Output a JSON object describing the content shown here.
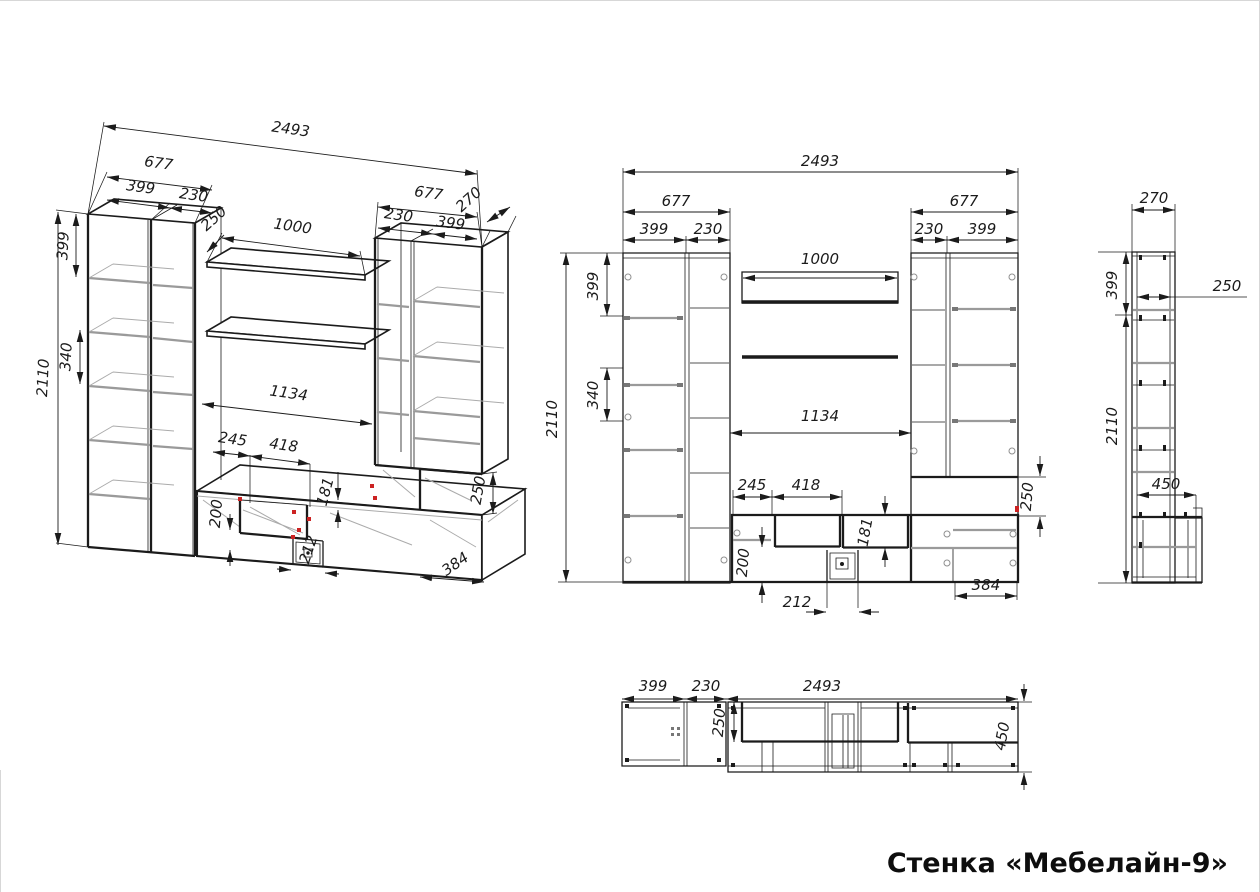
{
  "title": "Стенка «Мебелайн-9»",
  "colors": {
    "line": "#1b1b1b",
    "shelf_gray": "#9a9a9a",
    "accent_red": "#cc2222",
    "background": "#ffffff"
  },
  "dims": {
    "iso": {
      "total_width": "2493",
      "left_width": "677",
      "left_door": "399",
      "left_side": "230",
      "shelf_depth": "250",
      "shelf_width": "1000",
      "right_width": "677",
      "right_side": "230",
      "right_door": "399",
      "right_depth": "270",
      "top_height": "399",
      "mid_height": "340",
      "height": "2110",
      "niche_width": "1134",
      "w245": "245",
      "w418": "418",
      "h181": "181",
      "h200": "200",
      "w212": "212",
      "w384": "384",
      "h250": "250"
    },
    "front": {
      "total_width": "2493",
      "left_width": "677",
      "left_door": "399",
      "left_side": "230",
      "shelf_width": "1000",
      "right_width": "677",
      "right_side": "230",
      "right_door": "399",
      "top_height": "399",
      "mid_height": "340",
      "height": "2110",
      "niche_width": "1134",
      "w245": "245",
      "w418": "418",
      "h181": "181",
      "h200": "200",
      "h250": "250",
      "w212": "212",
      "w384": "384"
    },
    "side": {
      "depth": "270",
      "top_depth": "250",
      "top_height": "399",
      "height": "2110",
      "bottom_depth": "450"
    },
    "top": {
      "left_door": "399",
      "left_side": "230",
      "total_width": "2493",
      "top_depth": "250",
      "bottom_depth": "450"
    }
  }
}
